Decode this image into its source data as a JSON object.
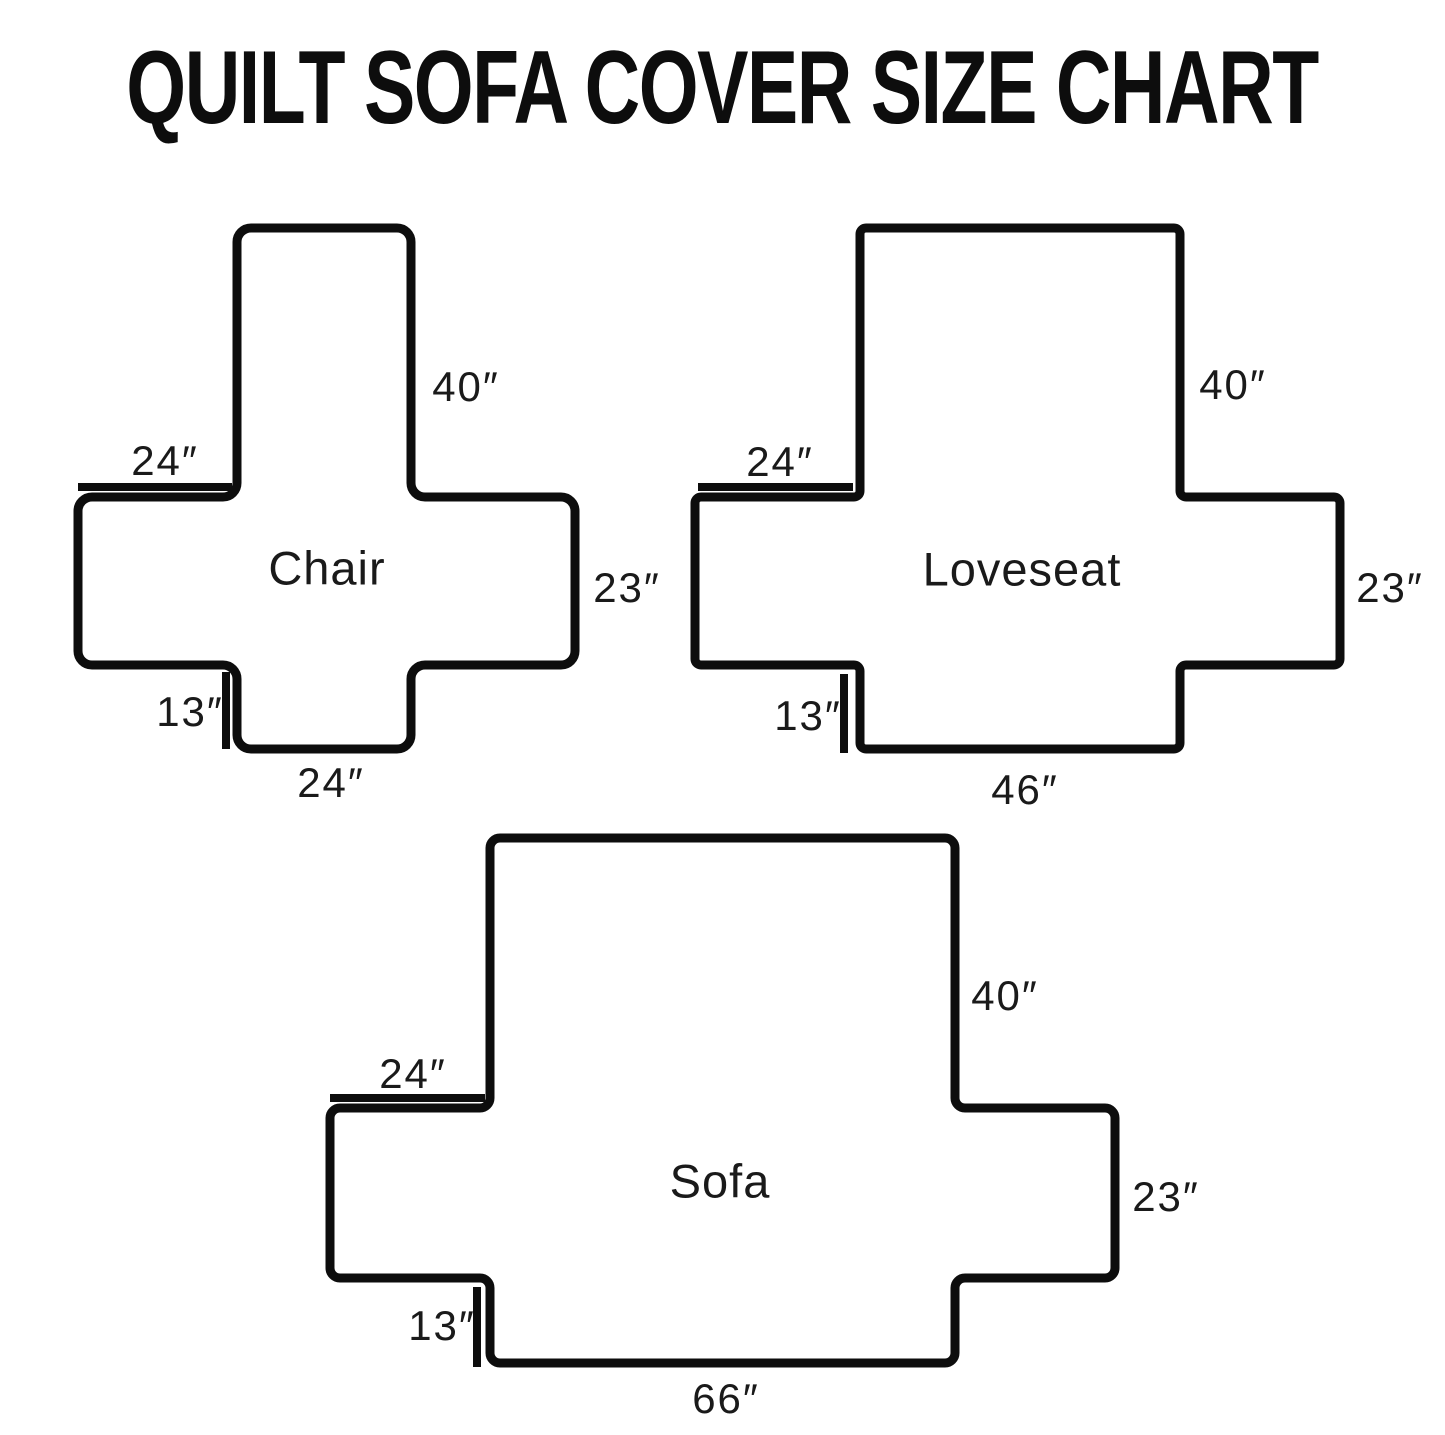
{
  "title": "QUILT SOFA COVER SIZE CHART",
  "figures": [
    {
      "name": "Chair",
      "back_height": "40″",
      "top_arm_width": "24″",
      "side_depth": "23″",
      "front_skirt": "13″",
      "seat_width": "24″"
    },
    {
      "name": "Loveseat",
      "back_height": "40″",
      "top_arm_width": "24″",
      "side_depth": "23″",
      "front_skirt": "13″",
      "seat_width": "46″"
    },
    {
      "name": "Sofa",
      "back_height": "40″",
      "top_arm_width": "24″",
      "side_depth": "23″",
      "front_skirt": "13″",
      "seat_width": "66″"
    }
  ]
}
